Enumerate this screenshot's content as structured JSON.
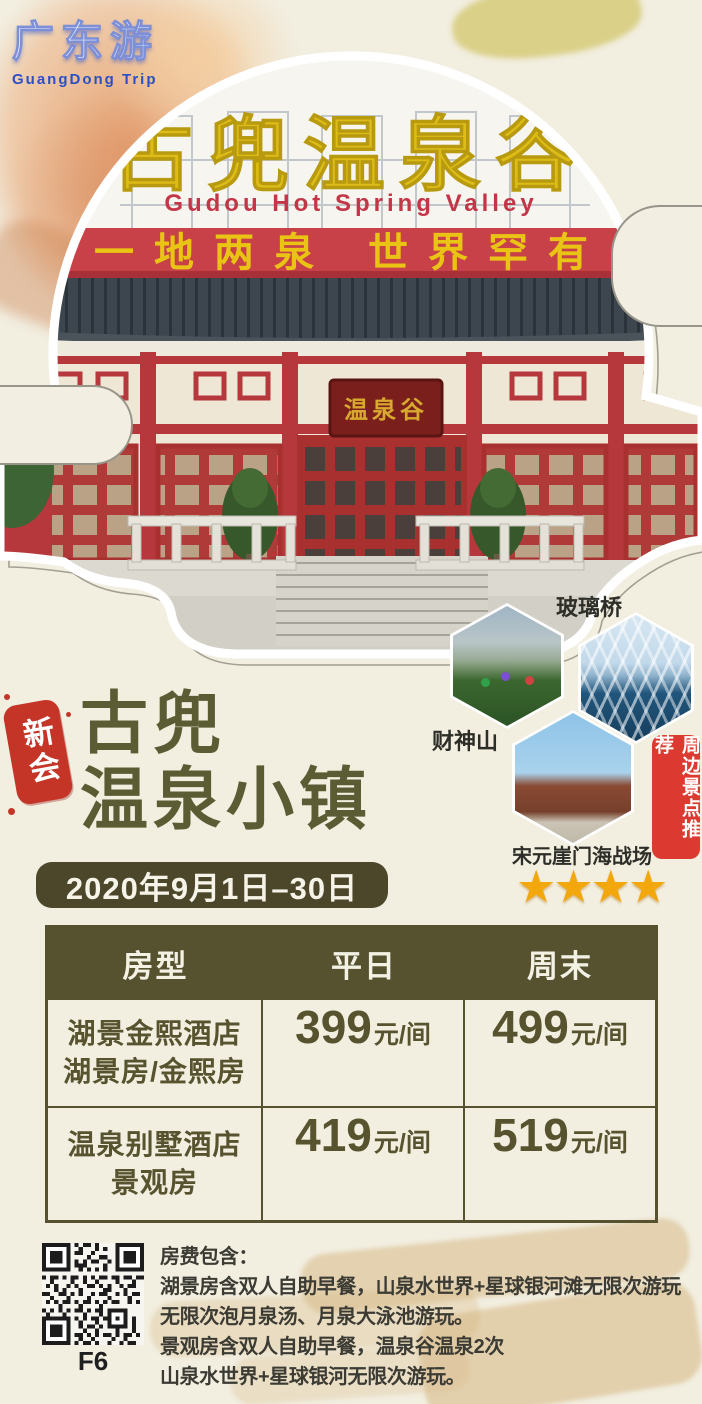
{
  "brand": {
    "name": "广东游",
    "subtitle": "GuangDong Trip"
  },
  "hero": {
    "sign_title": "古兜温泉谷",
    "sign_subtitle": "Gudou Hot Spring Valley",
    "sign_banner": "一地两泉 世界罕有",
    "plaque": "温泉谷"
  },
  "nearby": {
    "tag": "周边景点推荐",
    "spots": [
      {
        "label": "玻璃桥"
      },
      {
        "label": "财神山"
      },
      {
        "label": "宋元崖门海战场"
      }
    ]
  },
  "promo": {
    "seal": "新会",
    "title_line1": "古兜",
    "title_line2": "温泉小镇",
    "date_range": "2020年9月1日–30日",
    "rating_stars": "★★★★"
  },
  "price_table": {
    "headers": [
      "房型",
      "平日",
      "周末"
    ],
    "rows": [
      {
        "room_line1": "湖景金熙酒店",
        "room_line2": "湖景房/金熙房",
        "weekday_price": "399",
        "weekday_unit": "元/间",
        "weekend_price": "499",
        "weekend_unit": "元/间"
      },
      {
        "room_line1": "温泉别墅酒店",
        "room_line2": "景观房",
        "weekday_price": "419",
        "weekday_unit": "元/间",
        "weekend_price": "519",
        "weekend_unit": "元/间"
      }
    ]
  },
  "includes": {
    "qr_caption": "F6",
    "heading": "房费包含：",
    "lines": [
      "湖景房含双人自助早餐，山泉水世界+星球银河滩无限次游玩",
      "无限次泡月泉汤、月泉大泳池游玩。",
      "景观房含双人自助早餐，温泉谷温泉2次",
      "山泉水世界+星球银河无限次游玩。"
    ]
  },
  "colors": {
    "accent_olive": "#56522f",
    "accent_red": "#dc3a30",
    "star_gold": "#f2a70d",
    "sign_yellow": "#debc17"
  }
}
